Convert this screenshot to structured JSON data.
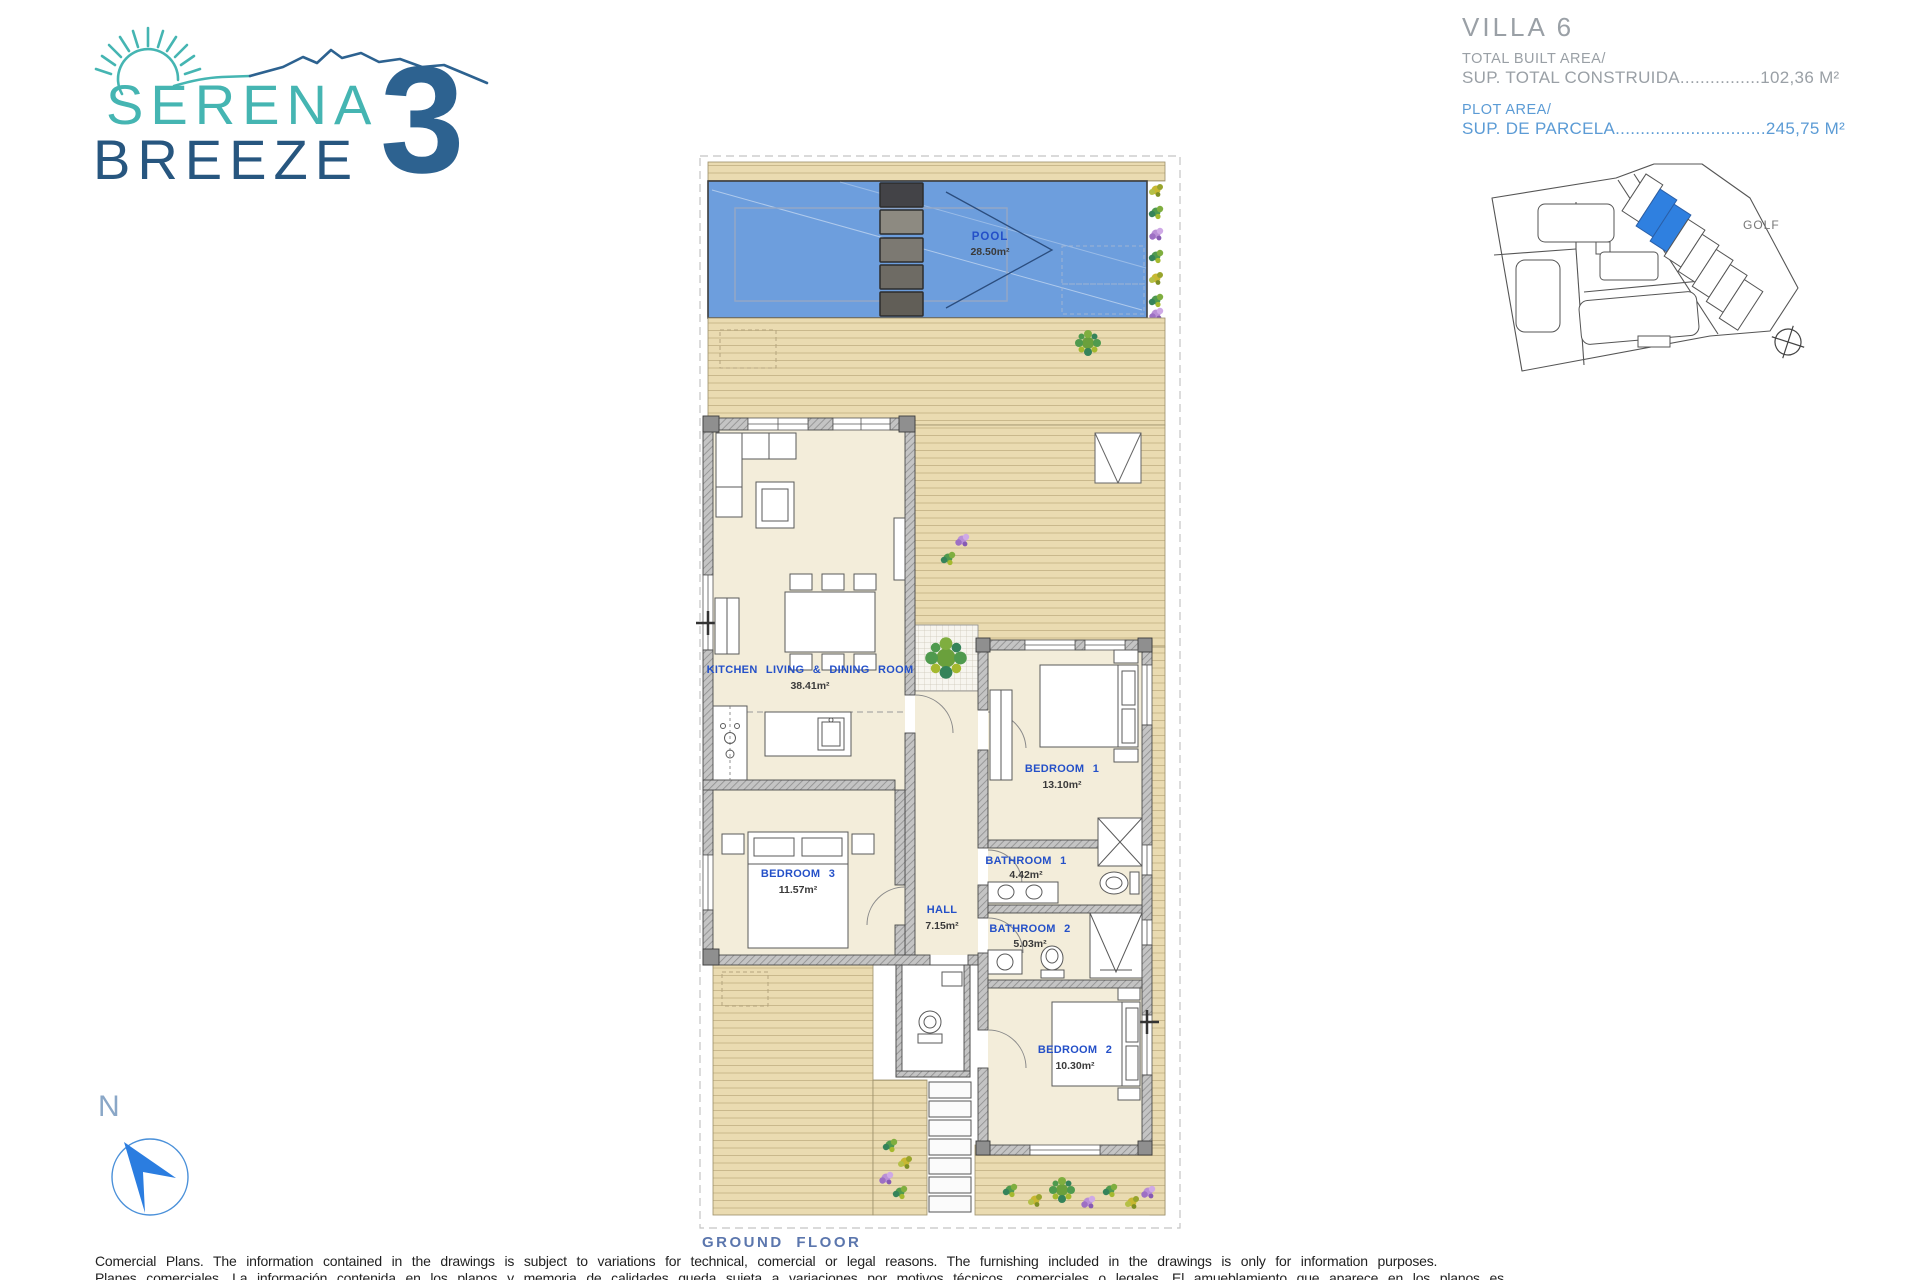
{
  "logo": {
    "word1": "SERENA",
    "word2": "BREEZE",
    "number": "3",
    "teal": "#45b5b2",
    "blue": "#2d6290"
  },
  "villa_info": {
    "title": "VILLA 6",
    "built_label": "TOTAL BUILT AREA/",
    "built_value_line": "SUP. TOTAL CONSTRUIDA................102,36 M²",
    "plot_label": "PLOT AREA/",
    "plot_value_line": "SUP. DE PARCELA..............................245,75 M²"
  },
  "site_map": {
    "golf_label": "GOLF",
    "highlight_color": "#2f80e0"
  },
  "rooms": {
    "pool": {
      "name": "POOL",
      "area": "28.50m²"
    },
    "kitchen": {
      "name": "KITCHEN LIVING & DINING ROOM",
      "area": "38.41m²"
    },
    "bedroom1": {
      "name": "BEDROOM 1",
      "area": "13.10m²"
    },
    "bedroom2": {
      "name": "BEDROOM 2",
      "area": "10.30m²"
    },
    "bedroom3": {
      "name": "BEDROOM 3",
      "area": "11.57m²"
    },
    "bathroom1": {
      "name": "BATHROOM 1",
      "area": "4.42m²"
    },
    "bathroom2": {
      "name": "BATHROOM 2",
      "area": "5.03m²"
    },
    "hall": {
      "name": "HALL",
      "area": "7.15m²"
    }
  },
  "plan": {
    "floor_label": "GROUND FLOOR",
    "pool_color": "#6d9edd",
    "deck_color": "#eadbb1",
    "room_color": "#f3edda",
    "label_blue": "#2450c8"
  },
  "compass": {
    "north": "N"
  },
  "footer": {
    "line1": "Comercial Plans. The information contained in the drawings is subject to variations for technical, comercial or legal reasons. The furnishing included in the drawings is only for information purposes.",
    "line2": "Planes comerciales. La información contenida en los planos y memoria de calidades queda sujeta a variaciones por motivos técnicos, comerciales o legales. El amueblamiento que aparece en los planos es meramente informativo."
  }
}
